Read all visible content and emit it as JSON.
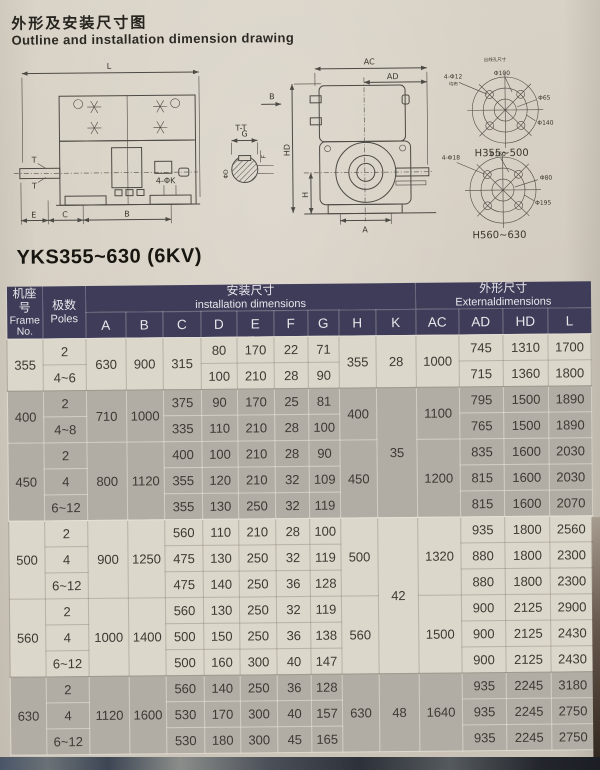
{
  "page": {
    "title_zh": "外形及安装尺寸图",
    "title_en": "Outline and installation dimension drawing",
    "model_label": "YKS355~630 (6KV)"
  },
  "drawing": {
    "side": {
      "L": "L",
      "E": "E",
      "C": "C",
      "B": "B",
      "T_upper": "T",
      "T_lower": "T",
      "holes": "4-ΦK"
    },
    "section": {
      "title": "T-T",
      "G": "G",
      "F": "F",
      "D": "ΦD"
    },
    "end": {
      "AC": "AC",
      "AD": "AD",
      "B": "B",
      "HD": "HD",
      "H": "H",
      "A": "A"
    },
    "flange_top": {
      "note": "出线孔尺寸",
      "bolt": "4-Φ12",
      "dist": "均布",
      "d1": "Φ100",
      "d2": "Φ65",
      "d3": "Φ140",
      "caption": "H355~500"
    },
    "flange_bottom": {
      "bolt": "4-Φ18",
      "d1": "Φ160",
      "d2": "Φ80",
      "d3": "Φ195",
      "caption": "H560~630"
    }
  },
  "table": {
    "header": {
      "frame_zh": "机座号",
      "frame_en": "Frame No.",
      "poles_zh": "极数",
      "poles_en": "Poles",
      "install_zh": "安装尺寸",
      "install_en": "installation dimensions",
      "install_cols": [
        "A",
        "B",
        "C",
        "D",
        "E",
        "F",
        "G",
        "H",
        "K"
      ],
      "external_zh": "外形尺寸",
      "external_en": "Externaldimensions",
      "external_cols": [
        "AC",
        "AD",
        "HD",
        "L"
      ]
    },
    "k_groups": [
      {
        "start": 0,
        "value": "28",
        "rows": 2
      },
      {
        "start": 2,
        "value": "35",
        "rows": 5
      },
      {
        "start": 7,
        "value": "42",
        "rows": 6
      },
      {
        "start": 13,
        "value": "48",
        "rows": 3
      }
    ],
    "groups": [
      {
        "frame": "355",
        "shade": "l",
        "A": "630",
        "B": "900",
        "C": "315",
        "H": "355",
        "AC": "1000",
        "rows": [
          {
            "poles": "2",
            "D": "80",
            "E": "170",
            "F": "22",
            "G": "71",
            "AD": "745",
            "HD": "1310",
            "L": "1700"
          },
          {
            "poles": "4~6",
            "D": "100",
            "E": "210",
            "F": "28",
            "G": "90",
            "AD": "715",
            "HD": "1360",
            "L": "1800"
          }
        ]
      },
      {
        "frame": "400",
        "shade": "g",
        "A": "710",
        "B": "1000",
        "H": "400",
        "AC": "1100",
        "rows": [
          {
            "poles": "2",
            "C": "375",
            "D": "90",
            "E": "170",
            "F": "25",
            "G": "81",
            "AD": "795",
            "HD": "1500",
            "L": "1890"
          },
          {
            "poles": "4~8",
            "C": "335",
            "D": "110",
            "E": "210",
            "F": "28",
            "G": "100",
            "AD": "765",
            "HD": "1500",
            "L": "1890"
          }
        ]
      },
      {
        "frame": "450",
        "shade": "g",
        "A": "800",
        "B": "1120",
        "H": "450",
        "AC": "1200",
        "rows": [
          {
            "poles": "2",
            "C": "400",
            "D": "100",
            "E": "210",
            "F": "28",
            "G": "90",
            "AD": "835",
            "HD": "1600",
            "L": "2030"
          },
          {
            "poles": "4",
            "C": "355",
            "D": "120",
            "E": "210",
            "F": "32",
            "G": "109",
            "AD": "815",
            "HD": "1600",
            "L": "2030"
          },
          {
            "poles": "6~12",
            "C": "355",
            "D": "130",
            "E": "250",
            "F": "32",
            "G": "119",
            "AD": "815",
            "HD": "1600",
            "L": "2070"
          }
        ]
      },
      {
        "frame": "500",
        "shade": "l",
        "A": "900",
        "B": "1250",
        "H": "500",
        "AC": "1320",
        "rows": [
          {
            "poles": "2",
            "C": "560",
            "D": "110",
            "E": "210",
            "F": "28",
            "G": "100",
            "AD": "935",
            "HD": "1800",
            "L": "2560"
          },
          {
            "poles": "4",
            "C": "475",
            "D": "130",
            "E": "250",
            "F": "32",
            "G": "119",
            "AD": "880",
            "HD": "1800",
            "L": "2300"
          },
          {
            "poles": "6~12",
            "C": "475",
            "D": "140",
            "E": "250",
            "F": "36",
            "G": "128",
            "AD": "880",
            "HD": "1800",
            "L": "2300"
          }
        ]
      },
      {
        "frame": "560",
        "shade": "l",
        "A": "1000",
        "B": "1400",
        "H": "560",
        "AC": "1500",
        "rows": [
          {
            "poles": "2",
            "C": "560",
            "D": "130",
            "E": "250",
            "F": "32",
            "G": "119",
            "AD": "900",
            "HD": "2125",
            "L": "2900"
          },
          {
            "poles": "4",
            "C": "500",
            "D": "150",
            "E": "250",
            "F": "36",
            "G": "138",
            "AD": "900",
            "HD": "2125",
            "L": "2430"
          },
          {
            "poles": "6~12",
            "C": "500",
            "D": "160",
            "E": "300",
            "F": "40",
            "G": "147",
            "AD": "900",
            "HD": "2125",
            "L": "2430"
          }
        ]
      },
      {
        "frame": "630",
        "shade": "g",
        "A": "1120",
        "B": "1600",
        "H": "630",
        "AC": "1640",
        "rows": [
          {
            "poles": "2",
            "C": "560",
            "D": "140",
            "E": "250",
            "F": "36",
            "G": "128",
            "AD": "935",
            "HD": "2245",
            "L": "3180"
          },
          {
            "poles": "4",
            "C": "530",
            "D": "170",
            "E": "300",
            "F": "40",
            "G": "157",
            "AD": "935",
            "HD": "2245",
            "L": "2750"
          },
          {
            "poles": "6~12",
            "C": "530",
            "D": "180",
            "E": "300",
            "F": "45",
            "G": "165",
            "AD": "935",
            "HD": "2245",
            "L": "2750"
          }
        ]
      }
    ]
  }
}
